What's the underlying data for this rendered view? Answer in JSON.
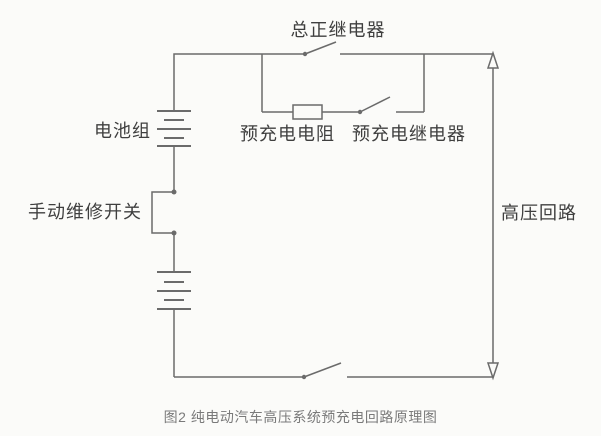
{
  "figure": {
    "caption": "图2 纯电动汽车高压系统预充电回路原理图"
  },
  "labels": {
    "main_positive_relay": "总正继电器",
    "battery_pack": "电池组",
    "precharge_resistor": "预充电电阻",
    "precharge_relay": "预充电继电器",
    "manual_service_switch": "手动维修开关",
    "high_voltage_loop": "高压回路"
  },
  "colors": {
    "wire": "#6b6b6b",
    "label_text": "#3f3f3f",
    "caption_text": "#7a7a7a",
    "background": "#fbfbf9"
  }
}
